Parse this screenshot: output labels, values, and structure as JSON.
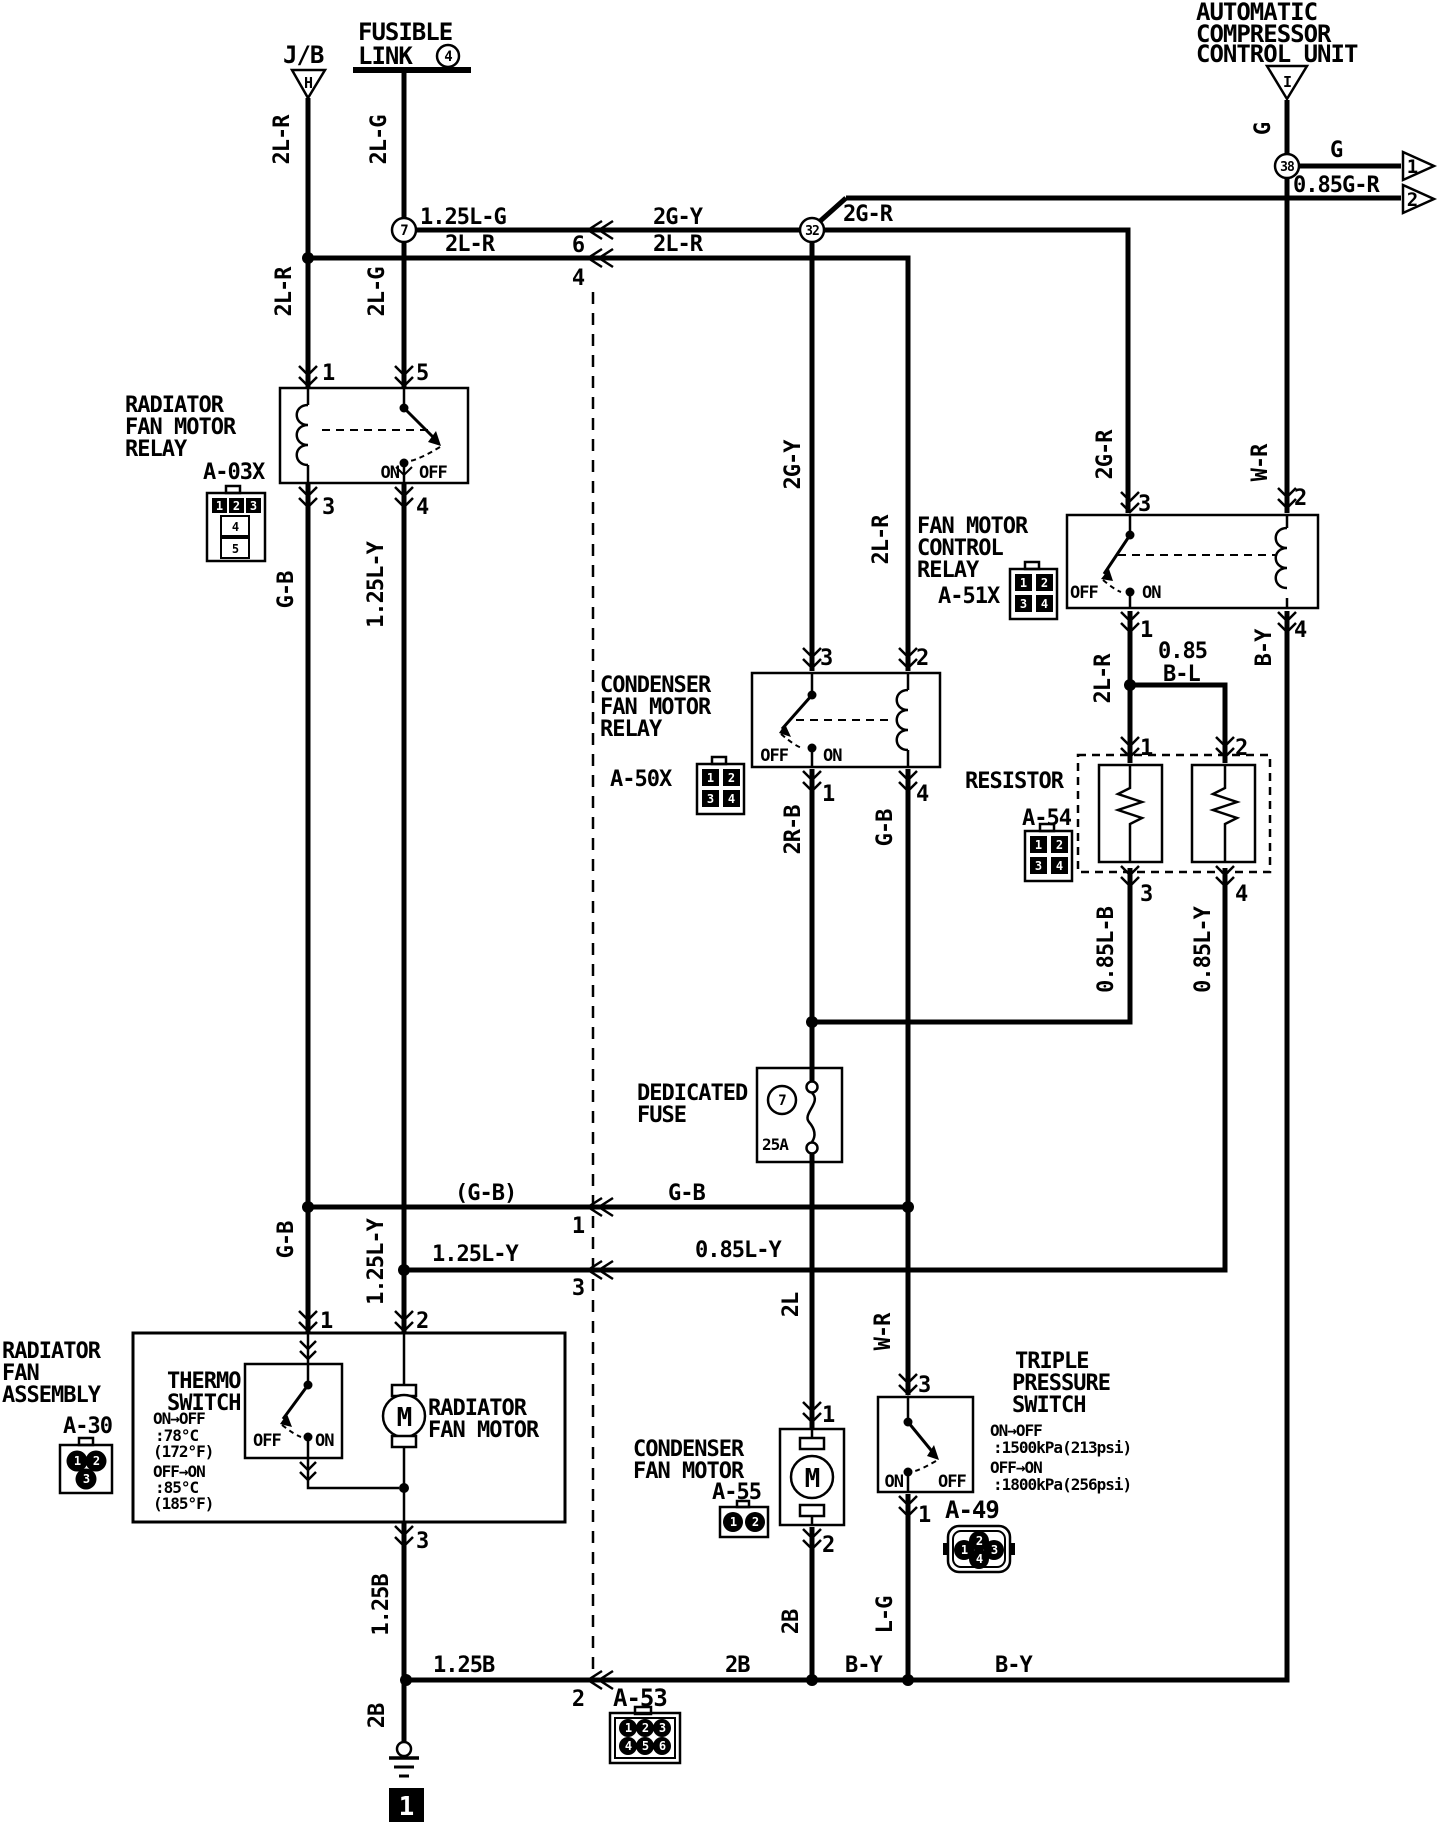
{
  "page": {
    "background": "#ffffff",
    "ink": "#000000"
  },
  "power_sources": {
    "junction_block": {
      "label": "J/B",
      "triangle_code": "H"
    },
    "fusible_link": {
      "title_line1": "FUSIBLE",
      "title_line2": "LINK",
      "number": "4"
    },
    "compressor_unit": {
      "title_line1": "AUTOMATIC",
      "title_line2": "COMPRESSOR",
      "title_line3": "CONTROL UNIT",
      "triangle_code": "I"
    }
  },
  "offpage_outputs": {
    "arrow1": {
      "num": "1",
      "wire": "G"
    },
    "arrow2": {
      "num": "2",
      "wire": "0.85G-R"
    }
  },
  "splices": {
    "s7": "7",
    "s32": "32",
    "s38": "38"
  },
  "wire_labels": {
    "v_2lr_top": "2L-R",
    "v_2lg_top": "2L-G",
    "v_2lr_mid": "2L-R",
    "v_2lg_mid": "2L-G",
    "h_125lg": "1.25L-G",
    "h_2gy": "2G-Y",
    "h_2lr_left": "2L-R",
    "h_2lr_right": "2L-R",
    "h_2gr": "2G-R",
    "v_2gy": "2G-Y",
    "v_2lr_cond": "2L-R",
    "v_2gr": "2G-R",
    "v_g": "G",
    "v_wr_top": "W-R",
    "v_gb_top": "G-B",
    "v_125ly_top": "1.25L-Y",
    "v_2lr_ctrl": "2L-R",
    "v_by": "B-Y",
    "h_085": "0.85",
    "h_bl": "B-L",
    "v_2rb": "2R-B",
    "v_gb_mid": "G-B",
    "v_085lb": "0.85L-B",
    "v_085ly": "0.85L-Y",
    "v_gb_bot": "G-B",
    "v_125ly_bot": "1.25L-Y",
    "h_gb_paren": "(G-B)",
    "h_gb": "G-B",
    "h_125ly": "1.25L-Y",
    "h_085ly": "0.85L-Y",
    "v_2l": "2L",
    "v_wr_bot": "W-R",
    "v_125b": "1.25B",
    "v_2b_cond": "2B",
    "v_lg": "L-G",
    "h_125b": "1.25B",
    "h_2b": "2B",
    "h_by_left": "B-Y",
    "h_by_right": "B-Y",
    "v_2b_gnd": "2B"
  },
  "inline_connector": {
    "code": "A-53",
    "pin_top1": "6",
    "pin_top2": "4",
    "pin_mid1": "1",
    "pin_mid2": "3",
    "pin_bottom": "2",
    "icon_pins": [
      "1",
      "2",
      "3",
      "4",
      "5",
      "6"
    ]
  },
  "radiator_relay": {
    "title_line1": "RADIATOR",
    "title_line2": "FAN MOTOR",
    "title_line3": "RELAY",
    "code": "A-03X",
    "pin1": "1",
    "pin5": "5",
    "pin3": "3",
    "pin4": "4",
    "on": "ON",
    "off": "OFF",
    "icon_pins": [
      "1",
      "2",
      "3",
      "4",
      "5"
    ]
  },
  "condenser_relay": {
    "title_line1": "CONDENSER",
    "title_line2": "FAN MOTOR",
    "title_line3": "RELAY",
    "code": "A-50X",
    "pin3": "3",
    "pin2": "2",
    "pin1": "1",
    "pin4": "4",
    "on": "ON",
    "off": "OFF",
    "icon_pins": [
      "1",
      "2",
      "3",
      "4"
    ]
  },
  "control_relay": {
    "title_line1": "FAN MOTOR",
    "title_line2": "CONTROL",
    "title_line3": "RELAY",
    "code": "A-51X",
    "pin3": "3",
    "pin2": "2",
    "pin1": "1",
    "pin4": "4",
    "on": "ON",
    "off": "OFF",
    "icon_pins": [
      "1",
      "2",
      "3",
      "4"
    ]
  },
  "resistor": {
    "title": "RESISTOR",
    "code": "A-54",
    "pin1": "1",
    "pin2": "2",
    "pin3": "3",
    "pin4": "4",
    "icon_pins": [
      "1",
      "2",
      "3",
      "4"
    ]
  },
  "dedicated_fuse": {
    "title_line1": "DEDICATED",
    "title_line2": "FUSE",
    "fuse_number": "7",
    "rating": "25A"
  },
  "radiator_assembly": {
    "title_line1": "RADIATOR",
    "title_line2": "FAN",
    "title_line3": "ASSEMBLY",
    "code": "A-30",
    "icon_pins": [
      "1",
      "2",
      "3"
    ],
    "pin1": "1",
    "pin2": "2",
    "pin3": "3",
    "thermo": {
      "title_line1": "THERMO",
      "title_line2": "SWITCH",
      "note1": "ON→OFF",
      "note2": ":78°C",
      "note3": "(172°F)",
      "note4": "OFF→ON",
      "note5": ":85°C",
      "note6": "(185°F)",
      "on": "ON",
      "off": "OFF"
    },
    "motor": {
      "label_line1": "RADIATOR",
      "label_line2": "FAN MOTOR",
      "symbol": "M"
    }
  },
  "condenser_motor": {
    "title_line1": "CONDENSER",
    "title_line2": "FAN MOTOR",
    "code": "A-55",
    "symbol": "M",
    "pin1": "1",
    "pin2": "2",
    "icon_pins": [
      "1",
      "2"
    ]
  },
  "pressure_switch": {
    "title_line1": "TRIPLE",
    "title_line2": "PRESSURE",
    "title_line3": "SWITCH",
    "note1": "ON→OFF",
    "note2": ":1500kPa(213psi)",
    "note3": "OFF→ON",
    "note4": ":1800kPa(256psi)",
    "code": "A-49",
    "pin3": "3",
    "pin1": "1",
    "on": "ON",
    "off": "OFF",
    "icon_pins": [
      "1",
      "2",
      "3",
      "4"
    ]
  },
  "ground": {
    "page_ref": "1"
  }
}
